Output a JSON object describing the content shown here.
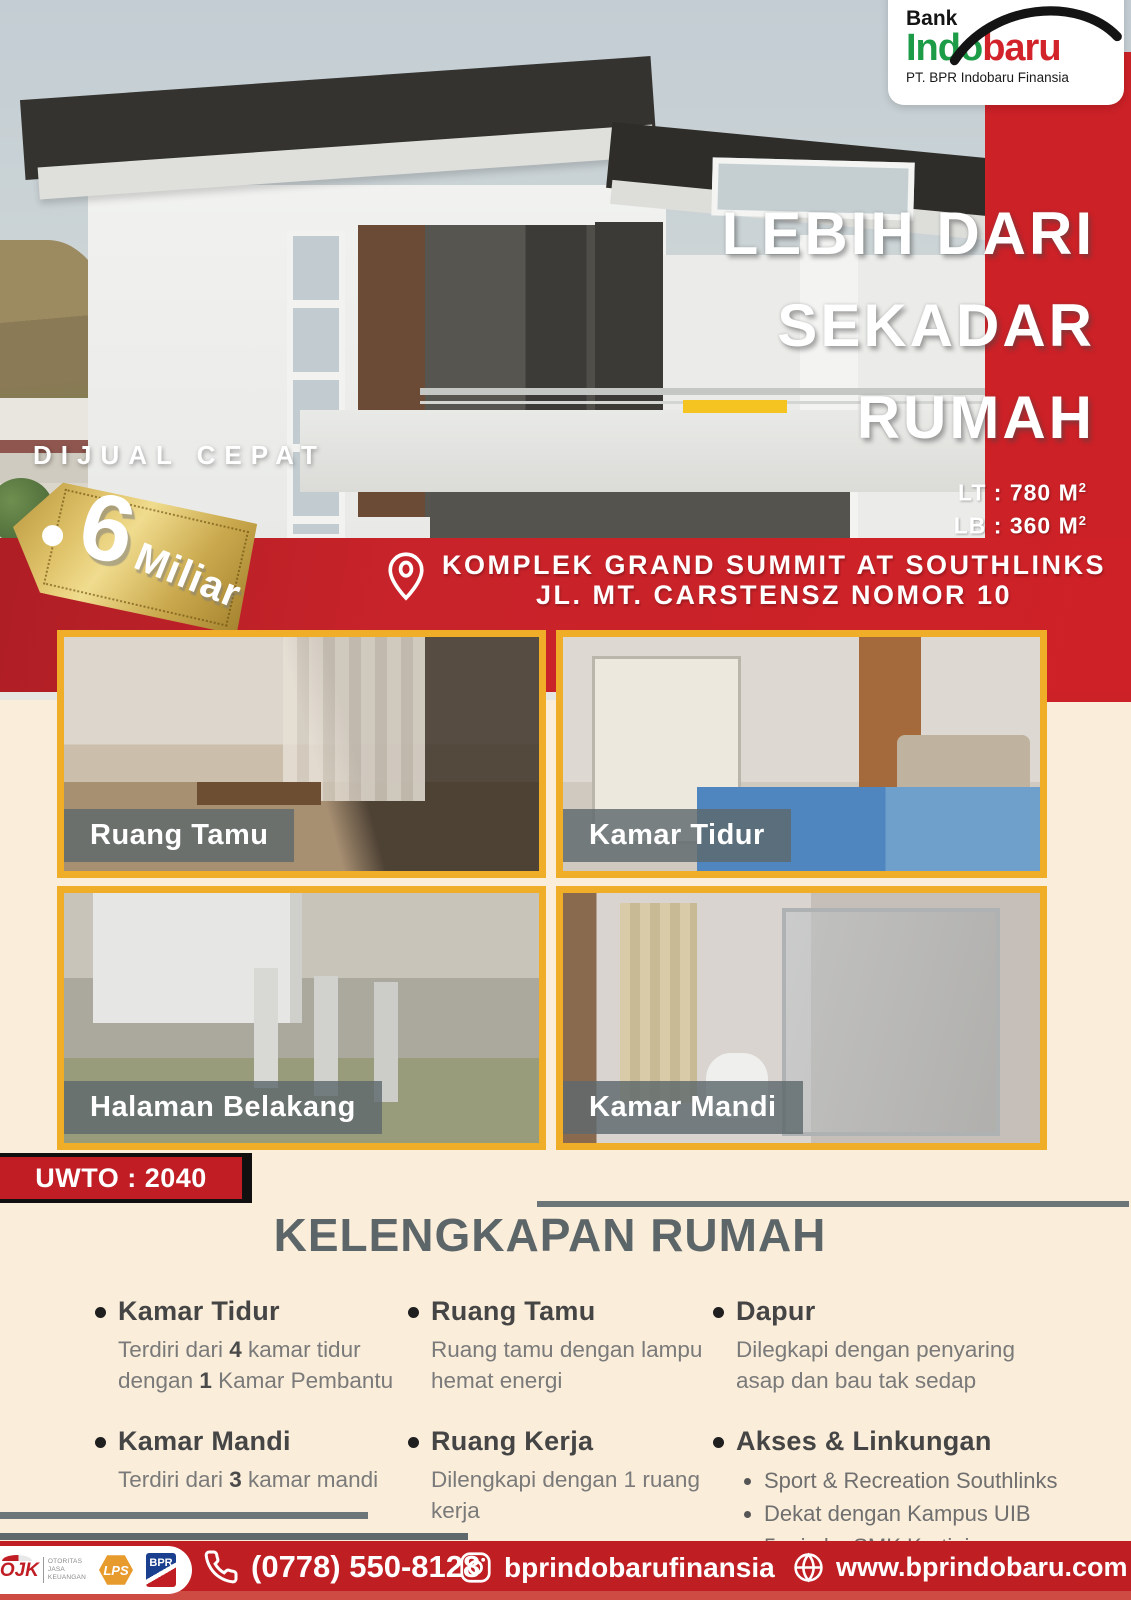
{
  "colors": {
    "primary_red": "#C8232A",
    "footer_red": "#BF1E23",
    "cream_background": "#FAEDDA",
    "gold_photo_border": "#F0AD27",
    "slate_gray": "#5C6568",
    "gold_tag": "#D4B45A",
    "brand_green": "#1C9C47",
    "brand_red": "#D2232A",
    "lps_orange": "#E89B2D",
    "yellow_dash": "#F5C421"
  },
  "brand": {
    "bank": "Bank",
    "name_part1": "Indo",
    "name_part2": "baru",
    "subtitle": "PT. BPR Indobaru Finansia"
  },
  "hero": {
    "headline_line1": "LEBIH DARI",
    "headline_line2": "SEKADAR",
    "headline_line3": "RUMAH",
    "sale_label": "DIJUAL CEPAT",
    "price_number": "6",
    "price_unit": "Miliar",
    "lt_label": "LT : 780 M",
    "lb_label": "LB : 360 M",
    "area_sup": "2",
    "address_line1": "KOMPLEK GRAND SUMMIT AT SOUTHLINKS",
    "address_line2": "JL. MT. CARSTENSZ NOMOR 10"
  },
  "gallery": {
    "tile1_label": "Ruang Tamu",
    "tile2_label": "Kamar Tidur",
    "tile3_label": "Halaman Belakang",
    "tile4_label": "Kamar Mandi"
  },
  "uwto_label": "UWTO : 2040",
  "features": {
    "title": "KELENGKAPAN RUMAH",
    "col1": {
      "item1": {
        "title": "Kamar Tidur",
        "p1": "Terdiri dari ",
        "b1": "4",
        "p2": " kamar tidur dengan ",
        "b2": "1",
        "p3": " Kamar Pembantu"
      },
      "item2": {
        "title": "Kamar Mandi",
        "p1": "Terdiri dari ",
        "b1": "3",
        "p2": " kamar mandi"
      }
    },
    "col2": {
      "item1": {
        "title": "Ruang Tamu",
        "p1": "Ruang tamu dengan lampu hemat energi"
      },
      "item2": {
        "title": "Ruang Kerja",
        "p1": "Dilengkapi dengan 1 ruang kerja"
      }
    },
    "col3": {
      "item1": {
        "title": "Dapur",
        "p1": "Dilegkapi dengan penyaring asap dan bau tak sedap"
      },
      "item2": {
        "title": "Akses & Linkungan",
        "bullets": [
          "Sport & Recreation Southlinks",
          "Dekat dengan Kampus UIB",
          "5 min ke SMK Kartini",
          "9 min. ke RS Awalbros"
        ]
      }
    }
  },
  "footer": {
    "phone": "(0778) 550-8128",
    "instagram": "bprindobarufinansia",
    "website": "www.bprindobaru.com",
    "ojk_name": "OJK",
    "ojk_caption_line1": "OTORITAS",
    "ojk_caption_line2": "JASA",
    "ojk_caption_line3": "KEUANGAN",
    "lps_label": "LPS",
    "bpr_label": "BPR"
  }
}
